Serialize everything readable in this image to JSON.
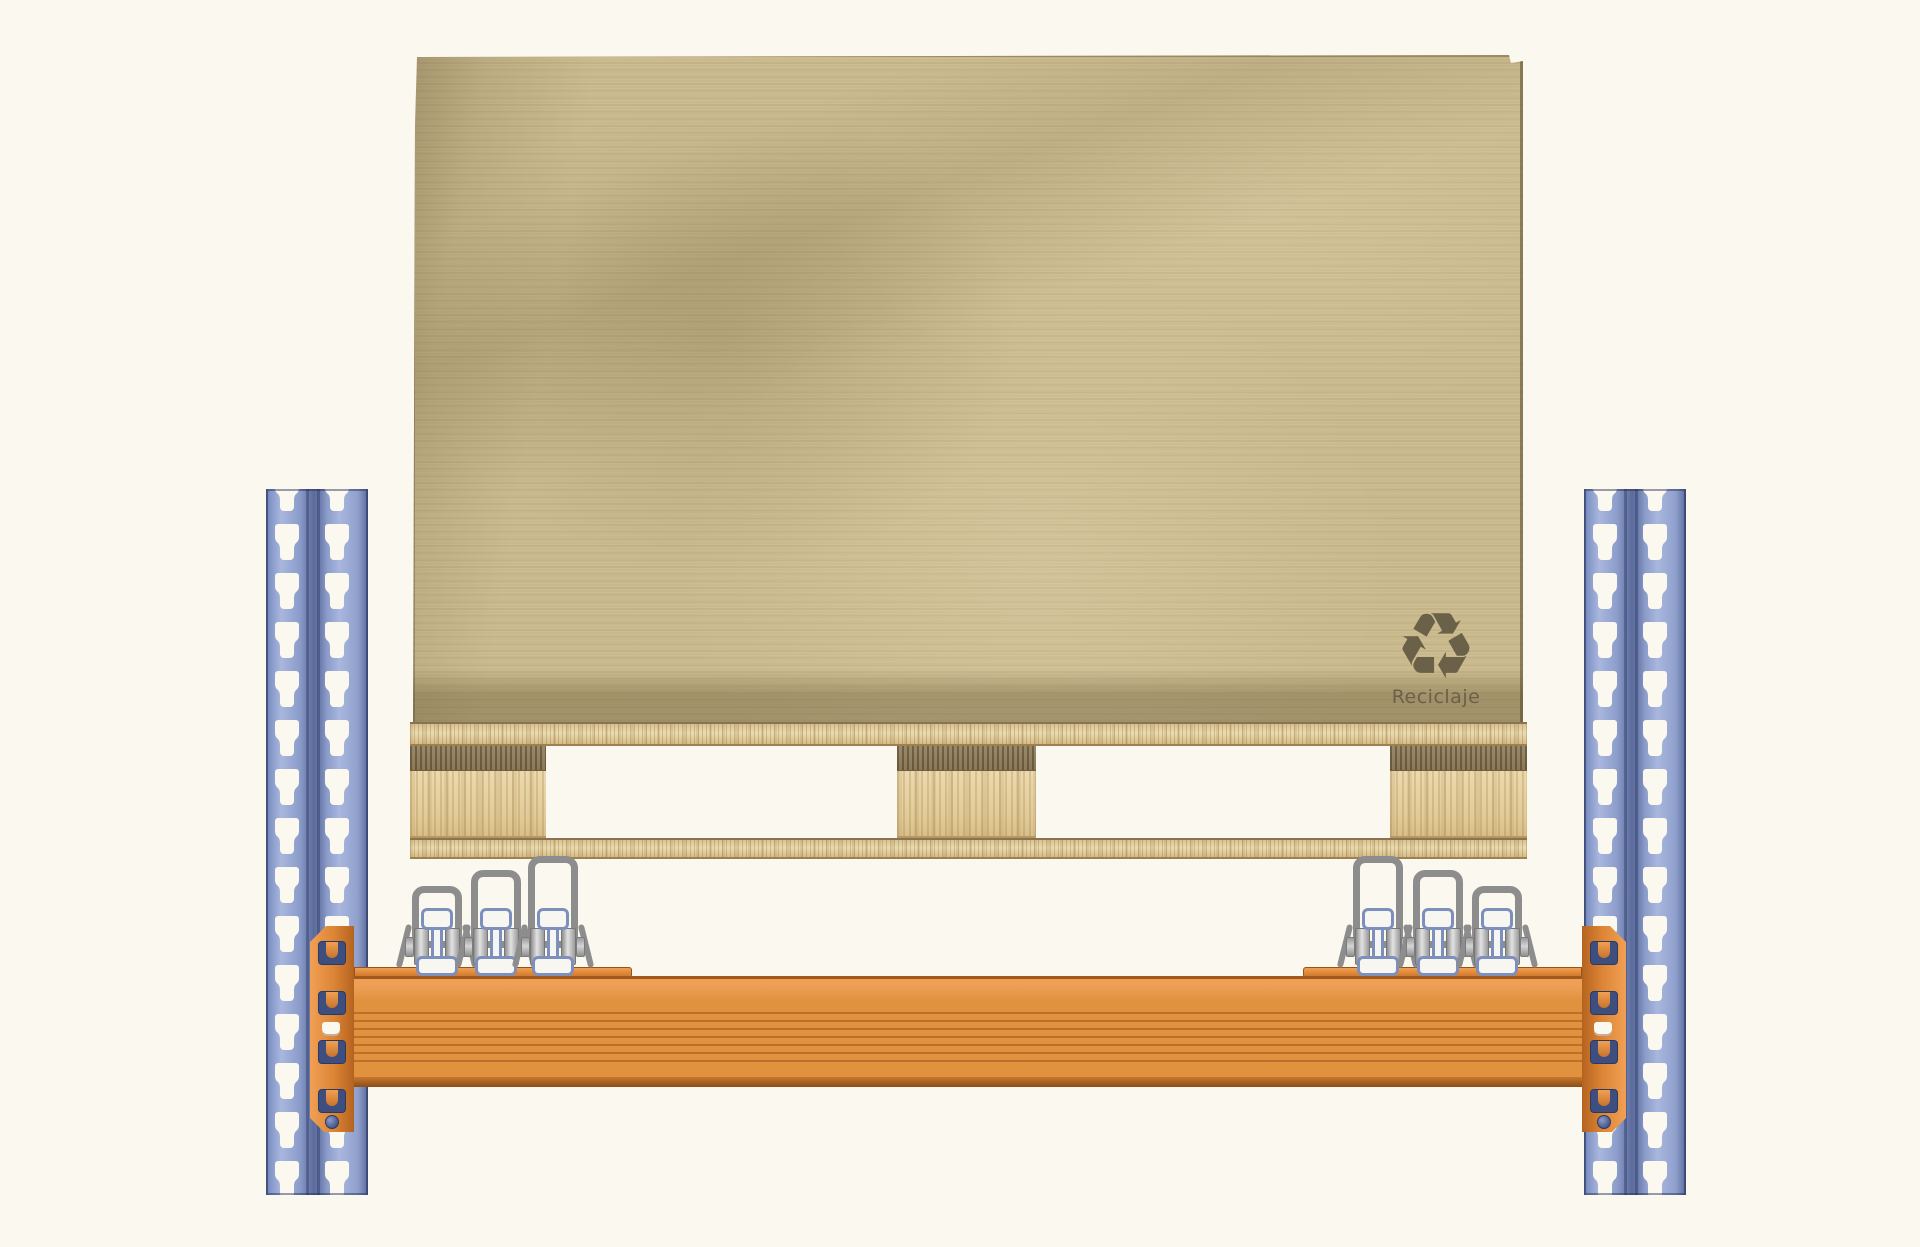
{
  "cover": {
    "recycle_symbol": "♻",
    "recycle_label": "Reciclaje"
  },
  "colors": {
    "background": "#fbf8ef",
    "kraft_paper": "#c9b98c",
    "paper_edge_shadow": "#a3936c",
    "upright_blue": "#8e9fce",
    "beam_orange": "#e2913f",
    "connector_orange": "#dd8435",
    "hook_navy": "#3e4e7e",
    "wood_light": "#e8d5a8",
    "wood_end_grain": "#8a7857",
    "roller_loop_grey": "#8d8d8d",
    "roller_bracket_blue": "#7d90bd"
  }
}
